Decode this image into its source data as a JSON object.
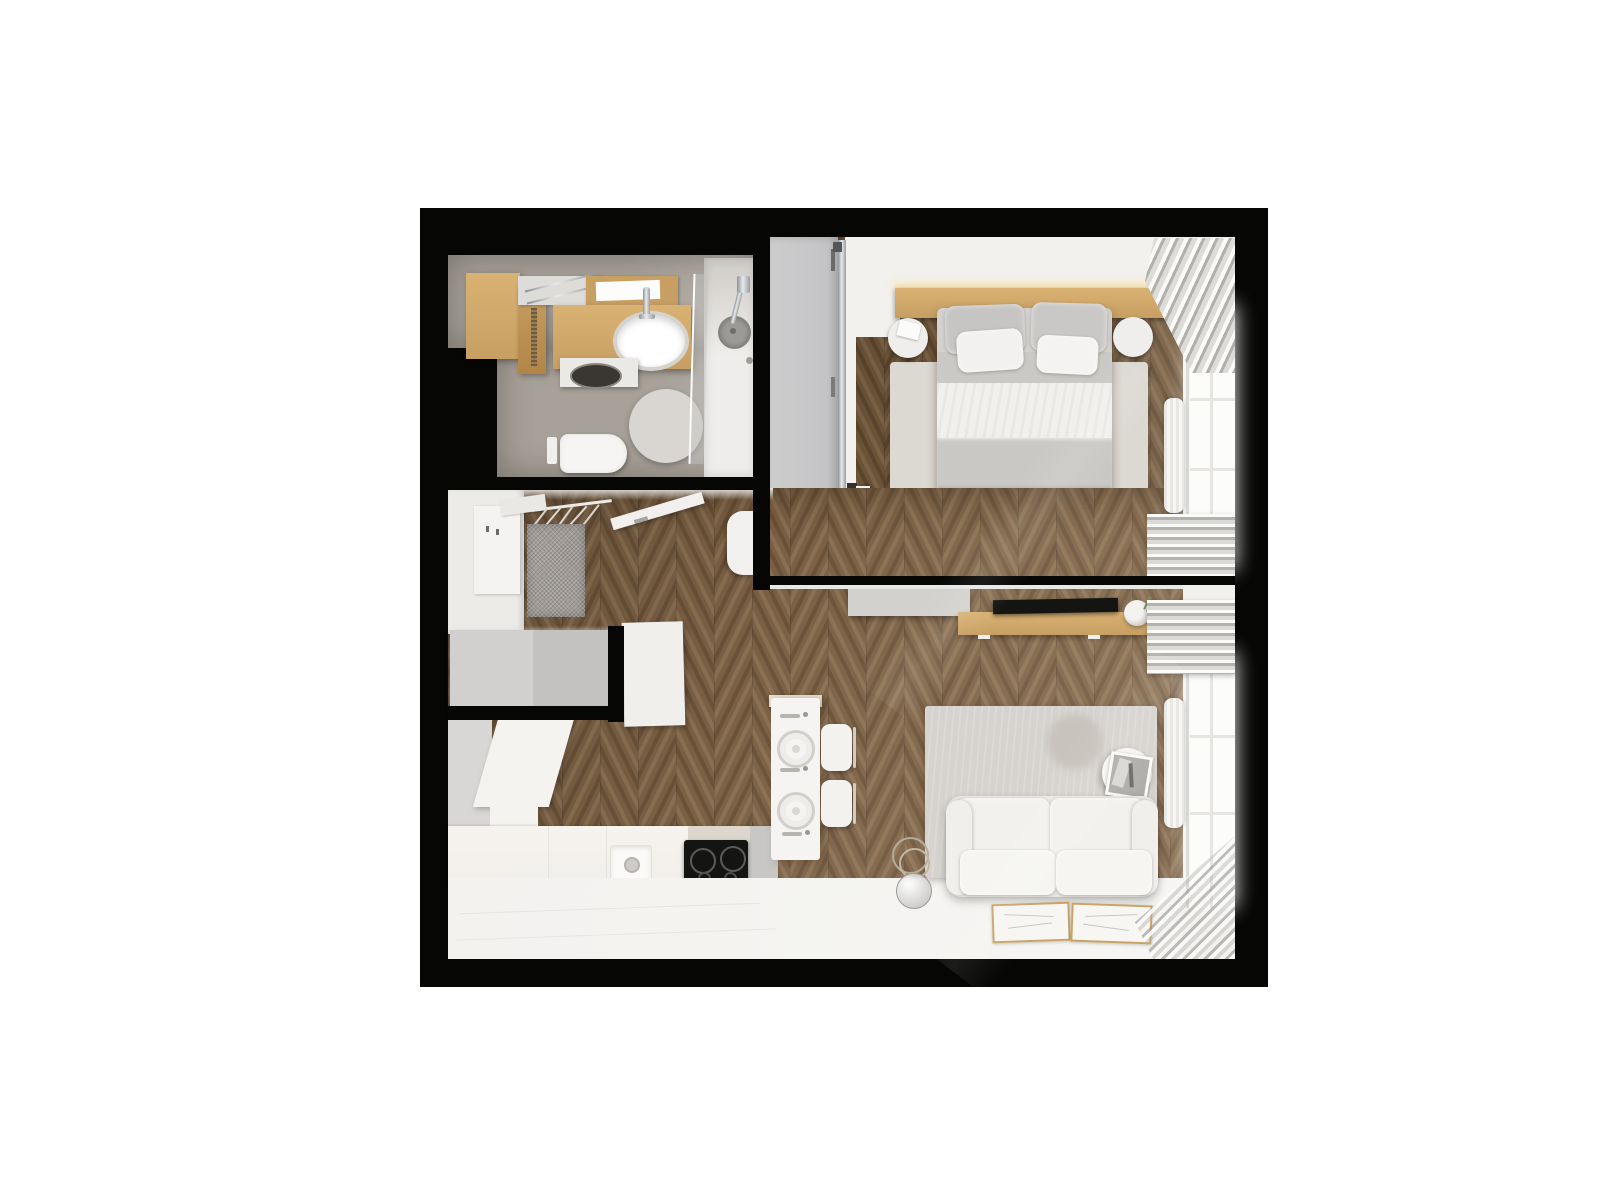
{
  "meta": {
    "kind": "floor-plan-render",
    "view": "top-down 3d apartment rendering",
    "background": "#ffffff"
  },
  "palette": {
    "frame": "#060605",
    "tile": "#a7a199",
    "tile-light": "#b6b0a8",
    "wood-light": "#d9b273",
    "wood-mid": "#c79f63",
    "wood-dark": "#b28447",
    "wood-frame": "#c9a466",
    "white-soft": "#f2f1ee",
    "white-bright": "#fcfcfb",
    "gray-cab": "#c9c9ca",
    "gray-mid": "#d2d1ce",
    "gray-dim": "#bbbabb",
    "rug-bed": "#dcd8d2",
    "rug-living": "#d6d3ce",
    "textile-gray": "#c7c5c1",
    "mat-gray": "#a19c97",
    "black-item": "#141413",
    "chrome-tone": "#b9bcbf",
    "plant-green": "#7e9167",
    "chevron-light-a": "#7b6044",
    "chevron-light-b": "#6a5238",
    "chevron-light-c": "#8a7052",
    "chevron-dark-a": "#6e5539",
    "chevron-dark-b": "#5c462e",
    "chevron-dark-c": "#7d6448"
  },
  "chevron": {
    "column_width": 38,
    "light": [
      "#7b6044",
      "#6a5238",
      "#8a7052"
    ],
    "dark": [
      "#6e5539",
      "#5c462e",
      "#7d6448"
    ]
  },
  "rooms": [
    {
      "id": "bathroom",
      "items": [
        "wood-cabinet",
        "towel-shelf",
        "mirror",
        "vanity-counter",
        "washbasin",
        "faucet",
        "laundry-basket",
        "toilet",
        "flush-plate",
        "round-rug",
        "shower-glass",
        "shower-tray",
        "shower-head"
      ]
    },
    {
      "id": "bedroom",
      "items": [
        "sliding-wardrobe",
        "bedroom-door",
        "headboard-shelf",
        "double-bed",
        "pillows",
        "nightstand-left",
        "nightstand-right",
        "book",
        "area-rug",
        "foot-bench",
        "wood-console",
        "decor-driftwood",
        "curtain-top",
        "curtain-bottom",
        "radiator",
        "window"
      ]
    },
    {
      "id": "hallway",
      "items": [
        "entry-door",
        "wall-shelf",
        "coat-rail",
        "hangers",
        "bathroom-door",
        "doormat",
        "pouf",
        "entry-closet"
      ]
    },
    {
      "id": "kitchen",
      "items": [
        "tall-cabinet",
        "l-shaped-counter",
        "sink",
        "induction-hob",
        "cutting-board",
        "dining-table",
        "place-setting",
        "chair"
      ]
    },
    {
      "id": "living-room",
      "items": [
        "sideboard",
        "tv",
        "tv-console",
        "vase-plant",
        "area-rug",
        "side-table",
        "photo-frame",
        "sofa",
        "floor-lamp",
        "floor-mats",
        "curtain-top",
        "curtain-bottom",
        "radiator",
        "window"
      ]
    }
  ]
}
